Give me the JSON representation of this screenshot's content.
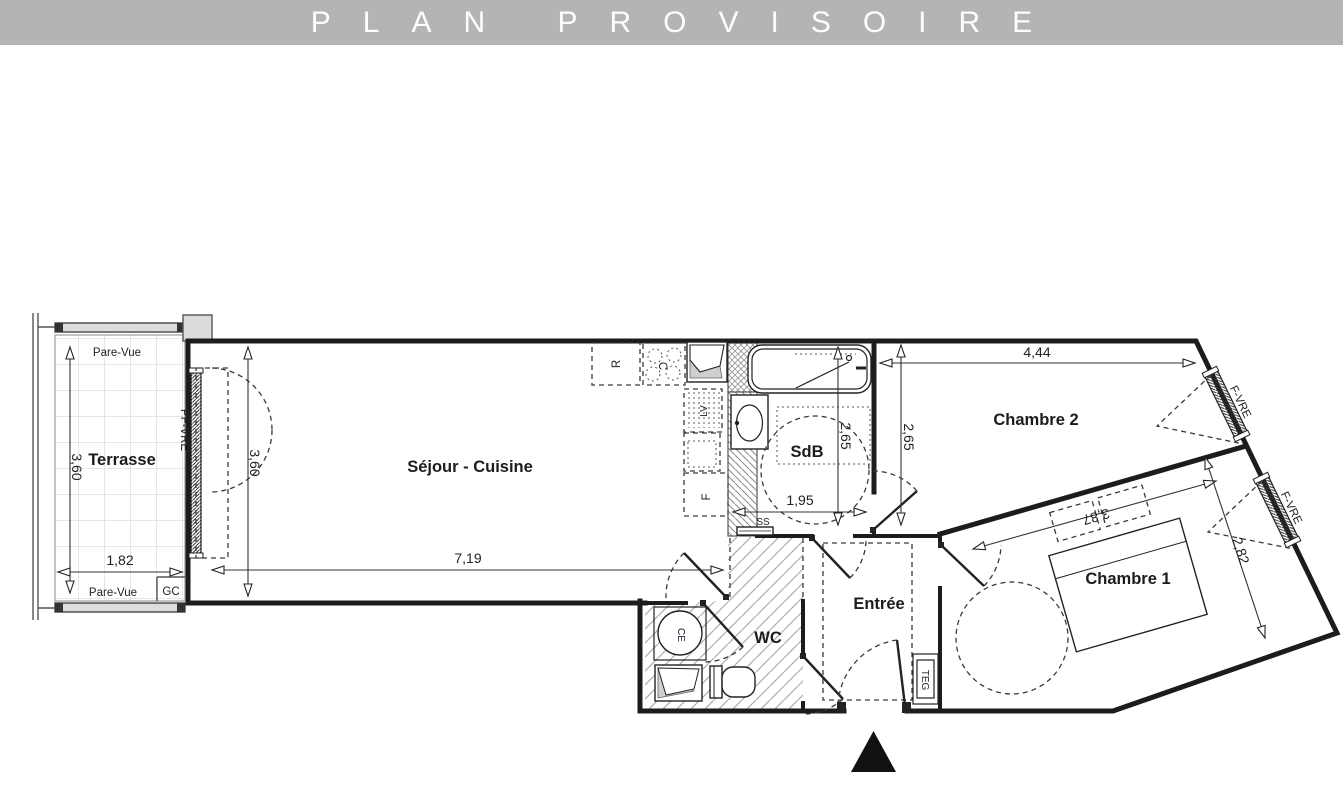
{
  "banner": {
    "title": "PLAN PROVISOIRE",
    "bg_color": "#b4b4b4",
    "text_color": "#fdfdfd"
  },
  "rooms": {
    "terrasse": {
      "label": "Terrasse",
      "width": "1,82",
      "depth": "3,60"
    },
    "sejour_cuisine": {
      "label": "Séjour - Cuisine",
      "width": "7,19",
      "depth": "3,60"
    },
    "sdb": {
      "label": "SdB",
      "width": "1,95",
      "depth": "2,65"
    },
    "chambre2": {
      "label": "Chambre 2",
      "width": "4,44",
      "depth": "2,65"
    },
    "chambre1": {
      "label": "Chambre 1",
      "width": "3,87",
      "depth": "2,82"
    },
    "wc": {
      "label": "WC"
    },
    "entree": {
      "label": "Entrée"
    }
  },
  "annotations": {
    "pare_vue_top": "Pare-Vue",
    "pare_vue_bottom": "Pare-Vue",
    "gc": "GC",
    "pf_vre": "PF-VRE",
    "f_vre_upper": "F-VRE",
    "f_vre_lower": "F-VRE",
    "ss": "SS",
    "ce": "CE",
    "teg": "TEG",
    "refrigerator": "R",
    "cooktop": "C",
    "dishwasher": "LV",
    "oven": "F"
  },
  "colors": {
    "wall": "#1c1c1c",
    "floor_hatch": "#b0b0b0",
    "tile_grid": "#cfcfcf",
    "entrance_marker": "#111111"
  }
}
